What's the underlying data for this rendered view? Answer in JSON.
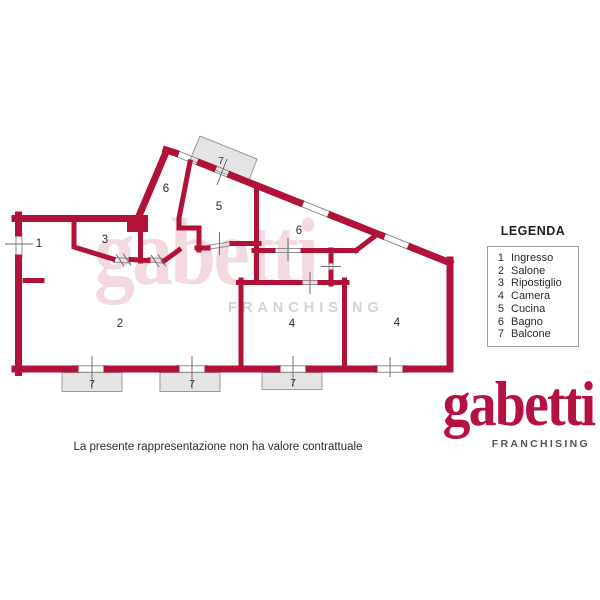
{
  "colors": {
    "wall_red": "#b11238",
    "brand_red": "#b5123f",
    "balcony_gray": "#e4e4e4",
    "watermark_gray": "#d3d3d3",
    "logo_gray": "#54565a",
    "text_dark": "#2b2b2b"
  },
  "plan": {
    "room_labels": [
      {
        "text": "1",
        "room": "ingresso"
      },
      {
        "text": "3",
        "room": "ripostiglio"
      },
      {
        "text": "6",
        "room": "bagno"
      },
      {
        "text": "5",
        "room": "cucina"
      },
      {
        "text": "6",
        "room": "bagno"
      },
      {
        "text": "2",
        "room": "salone"
      },
      {
        "text": "4",
        "room": "camera"
      },
      {
        "text": "4",
        "room": "camera"
      }
    ],
    "balcony_labels": [
      "7",
      "7",
      "7",
      "7"
    ]
  },
  "legend": {
    "title": "LEGENDA",
    "items": [
      {
        "num": "1",
        "label": "Ingresso"
      },
      {
        "num": "2",
        "label": "Salone"
      },
      {
        "num": "3",
        "label": "Ripostiglio"
      },
      {
        "num": "4",
        "label": "Camera"
      },
      {
        "num": "5",
        "label": "Cucina"
      },
      {
        "num": "6",
        "label": "Bagno"
      },
      {
        "num": "7",
        "label": "Balcone"
      }
    ]
  },
  "watermark": {
    "brand": "gabetti",
    "subtitle": "FRANCHISING"
  },
  "logo": {
    "brand": "gabetti",
    "subtitle": "FRANCHISING"
  },
  "footer": {
    "disclaimer": "La presente rappresentazione non ha valore contrattuale"
  }
}
